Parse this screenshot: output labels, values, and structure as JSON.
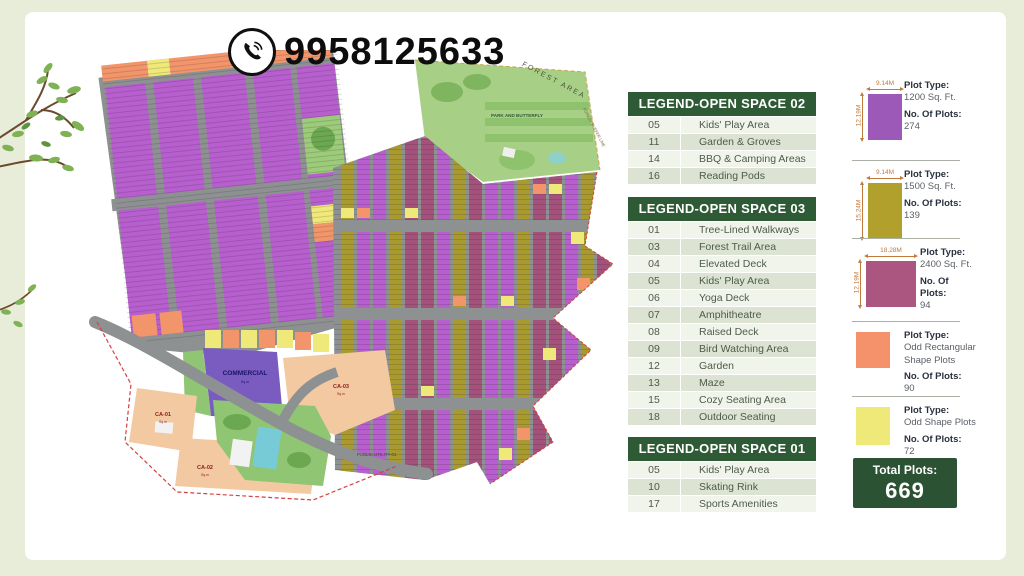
{
  "page": {
    "bg": "#E8EDD9",
    "card_bg": "#FFFFFF"
  },
  "phone": {
    "number": "9958125633"
  },
  "colors": {
    "legend_header": "#2E5B35",
    "total_box": "#2B5233",
    "purple": "#B75FCE",
    "olive": "#A89A2E",
    "magenta": "#A4527C",
    "orange": "#F2956A",
    "yellow": "#EFE97A",
    "road": "#8E9192",
    "peach": "#F3C9A2",
    "park_green": "#9CCB7A",
    "pool_blue": "#77CBD6",
    "commercial_purple": "#7A5BC0",
    "dim_label": "#C17A3C"
  },
  "map": {
    "labels": {
      "forest_area": "FOREST AREA",
      "forest_buffer": "FOREST BUFFER LINE",
      "park": "PARK AND BUTTERFLY",
      "commercial": "COMMERCIAL",
      "ca01": "CA-01",
      "ca02": "CA-02",
      "ca03": "CA-03",
      "public_utility": "PUBLIC UTILITY-01",
      "area_unit": "Sq.m"
    }
  },
  "legends": [
    {
      "title": "LEGEND-OPEN SPACE 02",
      "rows": [
        {
          "num": "05",
          "label": "Kids' Play Area"
        },
        {
          "num": "11",
          "label": "Garden & Groves"
        },
        {
          "num": "14",
          "label": "BBQ & Camping Areas"
        },
        {
          "num": "16",
          "label": "Reading Pods"
        }
      ]
    },
    {
      "title": "LEGEND-OPEN SPACE 03",
      "rows": [
        {
          "num": "01",
          "label": "Tree-Lined Walkways"
        },
        {
          "num": "03",
          "label": "Forest Trail Area"
        },
        {
          "num": "04",
          "label": "Elevated Deck"
        },
        {
          "num": "05",
          "label": "Kids' Play Area"
        },
        {
          "num": "06",
          "label": "Yoga Deck"
        },
        {
          "num": "07",
          "label": "Amphitheatre"
        },
        {
          "num": "08",
          "label": "Raised Deck"
        },
        {
          "num": "09",
          "label": "Bird Watching Area"
        },
        {
          "num": "12",
          "label": "Garden"
        },
        {
          "num": "13",
          "label": "Maze"
        },
        {
          "num": "15",
          "label": "Cozy Seating Area"
        },
        {
          "num": "18",
          "label": "Outdoor Seating"
        }
      ]
    },
    {
      "title": "LEGEND-OPEN SPACE 01",
      "rows": [
        {
          "num": "05",
          "label": "Kids' Play Area"
        },
        {
          "num": "10",
          "label": "Skating Rink"
        },
        {
          "num": "17",
          "label": "Sports Amenities"
        }
      ]
    }
  ],
  "plot_types": [
    {
      "dim_w": "9.14M",
      "dim_h": "12.19M",
      "color": "#9C59B8",
      "type_label": "Plot Type:",
      "type_value": "1200 Sq. Ft.",
      "plots_label": "No. Of Plots:",
      "plots_value": "274"
    },
    {
      "dim_w": "9.14M",
      "dim_h": "15.24M",
      "color": "#B1A02B",
      "type_label": "Plot Type:",
      "type_value": "1500 Sq. Ft.",
      "plots_label": "No. Of Plots:",
      "plots_value": "139"
    },
    {
      "dim_w": "18.28M",
      "dim_h": "12.19M",
      "color": "#AA5680",
      "type_label": "Plot Type:",
      "type_value": "2400 Sq. Ft.",
      "plots_label": "No. Of Plots:",
      "plots_value": "94"
    },
    {
      "color": "#F5926B",
      "type_label": "Plot Type:",
      "type_value": "Odd Rectangular Shape Plots",
      "plots_label": "No. Of Plots:",
      "plots_value": "90"
    },
    {
      "color": "#EFE97A",
      "type_label": "Plot Type:",
      "type_value": "Odd Shape Plots",
      "plots_label": "No. Of Plots:",
      "plots_value": "72"
    }
  ],
  "total": {
    "label": "Total Plots:",
    "value": "669"
  }
}
